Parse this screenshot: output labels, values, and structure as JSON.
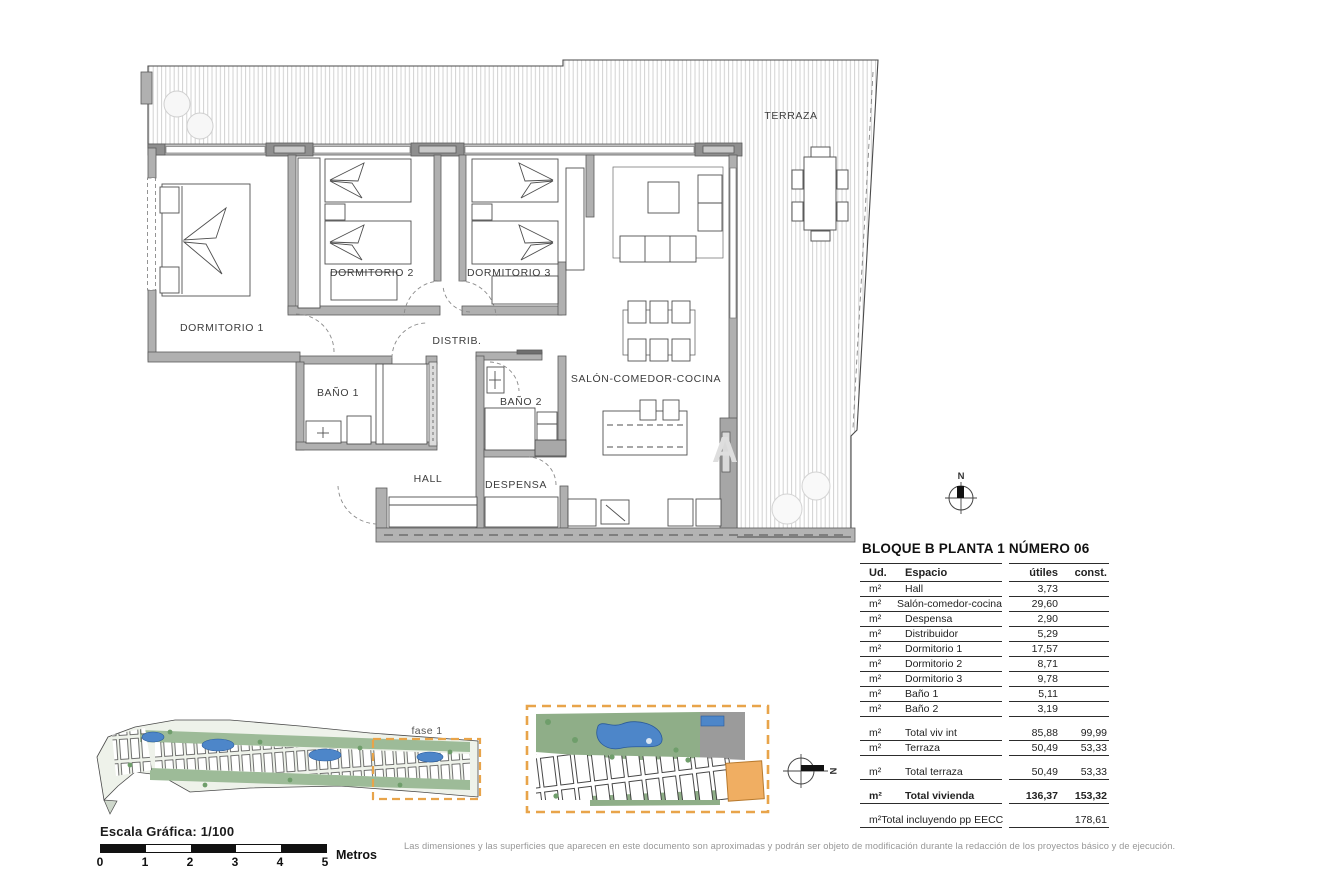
{
  "plan": {
    "labels": {
      "terraza": "TERRAZA",
      "dormitorio1": "DORMITORIO 1",
      "dormitorio2": "DORMITORIO 2",
      "dormitorio3": "DORMITORIO 3",
      "distrib": "DISTRIB.",
      "bano1": "BAÑO 1",
      "bano2": "BAÑO 2",
      "hall": "HALL",
      "despensa": "DESPENSA",
      "salon": "SALÓN-COMEDOR-COCINA"
    },
    "north": "N",
    "watermark": "A"
  },
  "site": {
    "fase_label": "fase 1",
    "north": "N"
  },
  "scale": {
    "title": "Escala Gráfica:  1/100",
    "ticks": [
      "0",
      "1",
      "2",
      "3",
      "4",
      "5"
    ],
    "unit": "Metros"
  },
  "table": {
    "title": "BLOQUE B  PLANTA 1  NÚMERO 06",
    "columns": {
      "ud": "Ud.",
      "espacio": "Espacio",
      "utiles": "útiles",
      "const": "const."
    },
    "sections": [
      {
        "rows": [
          {
            "ud": "m²",
            "espacio": "Hall",
            "utiles": "3,73",
            "const": ""
          },
          {
            "ud": "m²",
            "espacio": "Salón-comedor-cocina",
            "utiles": "29,60",
            "const": ""
          },
          {
            "ud": "m²",
            "espacio": "Despensa",
            "utiles": "2,90",
            "const": ""
          },
          {
            "ud": "m²",
            "espacio": "Distribuidor",
            "utiles": "5,29",
            "const": ""
          },
          {
            "ud": "m²",
            "espacio": "Dormitorio 1",
            "utiles": "17,57",
            "const": ""
          },
          {
            "ud": "m²",
            "espacio": "Dormitorio 2",
            "utiles": "8,71",
            "const": ""
          },
          {
            "ud": "m²",
            "espacio": "Dormitorio 3",
            "utiles": "9,78",
            "const": ""
          },
          {
            "ud": "m²",
            "espacio": "Baño 1",
            "utiles": "5,11",
            "const": ""
          },
          {
            "ud": "m²",
            "espacio": "Baño 2",
            "utiles": "3,19",
            "const": ""
          }
        ]
      },
      {
        "rows": [
          {
            "ud": "m²",
            "espacio": "Total viv int",
            "utiles": "85,88",
            "const": "99,99"
          },
          {
            "ud": "m²",
            "espacio": "Terraza",
            "utiles": "50,49",
            "const": "53,33"
          }
        ]
      },
      {
        "rows": [
          {
            "ud": "m²",
            "espacio": "Total terraza",
            "utiles": "50,49",
            "const": "53,33"
          }
        ]
      },
      {
        "rows": [
          {
            "ud": "m²",
            "espacio": "Total vivienda",
            "utiles": "136,37",
            "const": "153,32",
            "bold": true
          }
        ]
      },
      {
        "rows": [
          {
            "ud": "m²",
            "espacio": "Total incluyendo pp EECC",
            "utiles": "",
            "const": "178,61"
          }
        ]
      }
    ]
  },
  "footer": {
    "disclaimer": "Las dimensiones y las superficies que aparecen en este documento son aproximadas y podrán ser objeto de modificación durante la redacción de los proyectos básico y de ejecución."
  },
  "colors": {
    "accent_orange": "#E8A44A",
    "pool_blue": "#4D86C9",
    "wall_gray": "#ABABAB",
    "site_green": "#8FAE88",
    "highlight_building": "#F0AE62"
  }
}
